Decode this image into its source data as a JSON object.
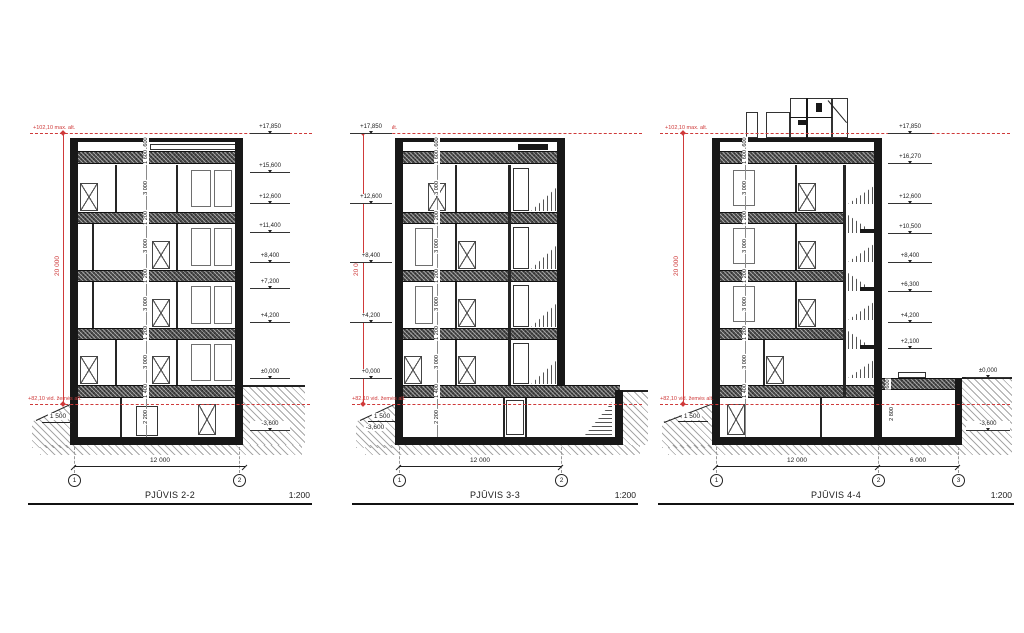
{
  "annotations": {
    "max_alt": "+102,10 max. alt.",
    "ground_alt": "+82,10 vid. žemės alt.",
    "overall_height_dim": "20 000",
    "ground_offset_dim": "1 500"
  },
  "sections": [
    {
      "title": "PJŪVIS 2-2",
      "scale": "1:200",
      "bubbles": [
        "1",
        "2"
      ],
      "span_dims": [
        "12 000"
      ],
      "levels": [
        "+17,850",
        "+15,600",
        "+12,600",
        "+11,400",
        "+8,400",
        "+7,200",
        "+4,200",
        "±0,000",
        "-3,600"
      ],
      "floor_dims": [
        "600",
        "1 600",
        "3 000",
        "1 200",
        "3 000",
        "1 200",
        "3 000",
        "1 200",
        "3 000",
        "1 400",
        "2 200"
      ]
    },
    {
      "title": "PJŪVIS 3-3",
      "scale": "1:200",
      "bubbles": [
        "1",
        "2"
      ],
      "span_dims": [
        "12 000"
      ],
      "levels": [
        "+17,850",
        "+12,600",
        "+8,400",
        "+4,200",
        "+0,000"
      ],
      "depth_label": "-3,600",
      "floor_dims": [
        "600",
        "1 600",
        "3 000",
        "1 200",
        "3 000",
        "1 200",
        "3 000",
        "1 200",
        "3 000",
        "1 400",
        "2 200"
      ]
    },
    {
      "title": "PJŪVIS 4-4",
      "scale": "1:200",
      "bubbles": [
        "1",
        "2",
        "3"
      ],
      "span_dims": [
        "12 000",
        "6 000"
      ],
      "levels": [
        "+17,850",
        "+16,270",
        "+12,600",
        "+10,500",
        "+8,400",
        "+6,300",
        "+4,200",
        "+2,100"
      ],
      "annex_levels": [
        "±0,000",
        "-3,600"
      ],
      "annex_dims": [
        "600",
        "2 800"
      ],
      "floor_dims": [
        "600",
        "1 600",
        "3 000",
        "1 200",
        "3 000",
        "1 200",
        "3 000",
        "1 200",
        "3 000",
        "1 400"
      ]
    }
  ]
}
